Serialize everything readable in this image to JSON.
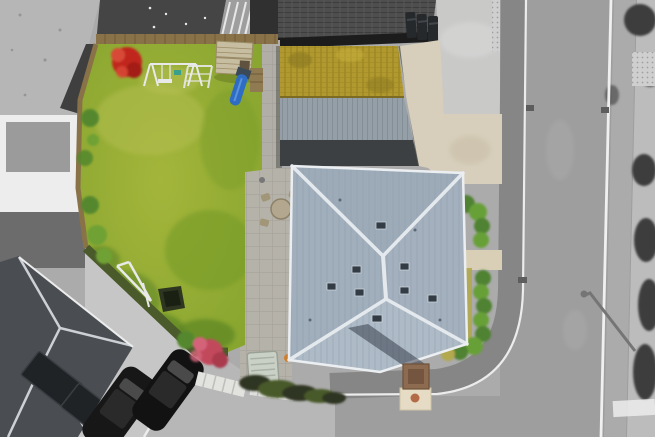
{
  "scene": {
    "type": "aerial-drone-photograph",
    "alt": "Overhead aerial photo of a property highlighted in colour: lawned rear garden with play equipment, shed and blue slide, a garage with moss-covered and metal roof slopes, a beige driveway with bins, and a large pale-blue hipped roof house with chimney; surrounding neighbouring houses, parked cars, pavements and the road are shown in black and white."
  },
  "colors": {
    "bwBase": "#ababab",
    "bwLightGravel": "#b6b6b6",
    "bwSpeck": "#8d8d8d",
    "bwDarkRoof": "#454545",
    "bwDarkRoof2": "#3f3f3f",
    "bwStripe": "#e8e8e8",
    "bwStripeBg": "#9e9e9e",
    "bwBlock": "#303030",
    "bwTileRoof": "#4e4e4e",
    "bwTileLine": "#3a3a3a",
    "bwTileLite": "#5c5c5c",
    "bwEave": "#1c1c1c",
    "bwConcrete": "#c9c9c8",
    "bwConcreteLight": "#d6d6d5",
    "bwWhiteBldg": "#ededed",
    "bwFlatRoof": "#9b9b9b",
    "bwDriveDark": "#6c6c6c",
    "bwDriveLight": "#c6c6c6",
    "bwNeighborRoof": "#4a4e52",
    "bwRidge": "#cdd1d5",
    "bwSolar": "#202326",
    "bwSolarLine": "#3a3e42",
    "bwCar1": "#171717",
    "bwCar2": "#121212",
    "carGlass": "#4a4a4a",
    "carRoof": "#2a2a2a",
    "bwKerb": "#ececec",
    "bwPavement": "#b7b7b7",
    "roadGray": "#9e9e9e",
    "sidewalkDark": "#868686",
    "sidewalkRight": "#ababab",
    "pavementRight": "#bcbcbc",
    "roadLine": "#f0f0f0",
    "drain": "#5d5d5d",
    "shadowGray": "#757575",
    "bushBW": "#3d3d3d",
    "binBody": "#26292c",
    "binLid": "#41464b",
    "tactile": "#cfcfcf",
    "tactileDot": "#9f9f9f",
    "lawnLight": "#a4b53b",
    "lawnBase": "#85a42e",
    "lawnDark": "#759b2a",
    "lawnShadow": "#5c8424",
    "lawnWorn": "#b7c155",
    "fenceWood": "#8a7248",
    "fenceWoodDark": "#6e5a36",
    "shrubBoundary": "#4a5a2a",
    "plantGreen": "#55882e",
    "plantGreen2": "#6fa136",
    "acerRed": "#c1271b",
    "acerRedDark": "#a41d12",
    "acerRedLight": "#d84a37",
    "acerPink": "#c2495c",
    "acerPinkLight": "#d4647a",
    "acerPinkDark": "#a93a4d",
    "playWhite": "#e9e9e9",
    "tealToy": "#3aa08a",
    "shedBody": "#c7bda0",
    "shedLine": "#9b8c68",
    "shedDark": "#5f5340",
    "palletWood": "#8f7a52",
    "slideBlue": "#2f6cc4",
    "slideBlueLight": "#5b92dd",
    "platformDark": "#3b4a56",
    "netDark": "#2e3520",
    "netDarker": "#1a2112",
    "mossRoof": "#b1992f",
    "mossLine": "#8a761c",
    "mossLine2": "#a08a24",
    "mossDark": "#8a7820",
    "mossLight": "#c9b13c",
    "ridgeBrown": "#7d6b22",
    "metalRoof": "#949fa8",
    "metalLine": "#7e8992",
    "garageDark": "#3c4043",
    "garageShadow": "#55584f",
    "driveBeige": "#d7cebb",
    "driveStain": "#c9bfa8",
    "pathBeige": "#d8cfb6",
    "patio": "#b5b2aa",
    "patioLine": "#9d9a92",
    "patioStrip": "#b0aea6",
    "tableTan": "#b3a78f",
    "tableEdge": "#8d8168",
    "chairTan": "#a29678",
    "heatPump": "#c9d0c6",
    "heatPumpLine": "#aab0a6",
    "heatPumpEdge": "#9aa096",
    "potOrange": "#cd7f2e",
    "potDark": "#3f3f3f",
    "fenceWhite": "#e2e2df",
    "fenceWhiteLine": "#bdbdb9",
    "hedgeGreen": "#4f8230",
    "hedgeGreen2": "#67a038",
    "dryGrass": "#b3a94f",
    "houseRoofN": "#9dabb9",
    "houseRoofE": "#a4b0bd",
    "houseRoofS": "#aebac6",
    "houseRoofW": "#a1aebb",
    "roofSeam": "#8fa0af",
    "roofRidge": "#e4e9ee",
    "roofFascia": "#eceff2",
    "roofWindow": "#333b44",
    "roofWindowEdge": "#c8d2da",
    "roofVent": "#5c6974",
    "chimneyShadow": "#2b3240",
    "chimneyBrick": "#8c6b50",
    "chimneyBrickDark": "#6e523a",
    "chimneyInner": "#745640",
    "chimneyBase": "#e6dcc5",
    "chimneyBaseEdge": "#cfc3a6",
    "terracotta": "#b36b47"
  }
}
